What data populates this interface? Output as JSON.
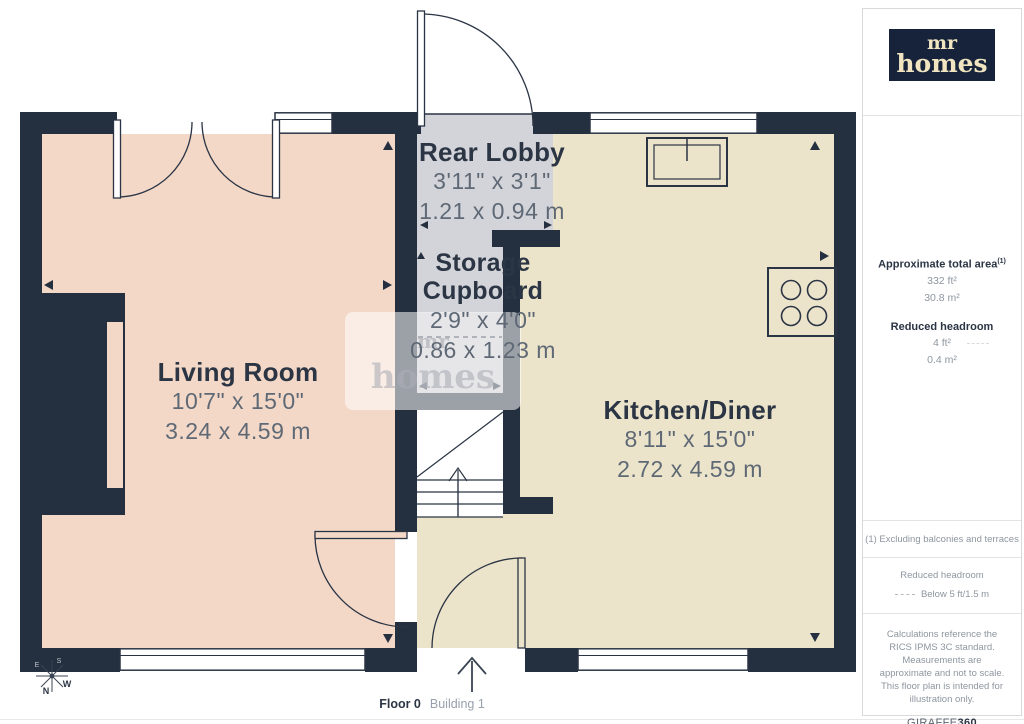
{
  "branding": {
    "logo_line1": "mr",
    "logo_line2": "homes"
  },
  "rooms": {
    "living": {
      "name": "Living Room",
      "imperial": "10'7\" x 15'0\"",
      "metric": "3.24 x 4.59 m"
    },
    "kitchen": {
      "name": "Kitchen/Diner",
      "imperial": "8'11\" x 15'0\"",
      "metric": "2.72 x 4.59 m"
    },
    "lobby": {
      "name": "Rear Lobby",
      "imperial": "3'11\" x 3'1\"",
      "metric": "1.21 x 0.94 m"
    },
    "storage": {
      "name_line1": "Storage",
      "name_line2": "Cupboard",
      "imperial": "2'9\" x 4'0\"",
      "metric": "0.86 x 1.23 m"
    }
  },
  "sidebar": {
    "area_title": "Approximate total area",
    "area_title_sup": "(1)",
    "area_ft": "332 ft²",
    "area_m": "30.8 m²",
    "headroom_title": "Reduced headroom",
    "headroom_ft": "4 ft²",
    "headroom_m": "0.4 m²",
    "note": "(1) Excluding balconies and terraces",
    "legend_title": "Reduced headroom",
    "legend_value": "Below 5 ft/1.5 m",
    "disclaimer": "Calculations reference the RICS IPMS 3C standard. Measurements are approximate and not to scale. This floor plan is intended for illustration only.",
    "brand_name": "GIRAFFE",
    "brand_number": "360"
  },
  "floor_label": {
    "floor": "Floor 0",
    "building": "Building 1"
  },
  "watermark": {
    "line1": "mr",
    "line2": "homes"
  },
  "compass": {
    "n": "N",
    "w": "W",
    "e": "E",
    "s": "S"
  },
  "colors": {
    "wall": "#242f3f",
    "living_room_fill": "#f3d8c7",
    "kitchen_fill": "#ece4ca",
    "lobby_fill": "#d3d4d9",
    "reduced_headroom_fill": "#c7c8ce",
    "logo_bg": "#16233a",
    "logo_text": "#f0e5c0",
    "label_dark": "#2b3544",
    "label_gray": "#5f6975"
  }
}
